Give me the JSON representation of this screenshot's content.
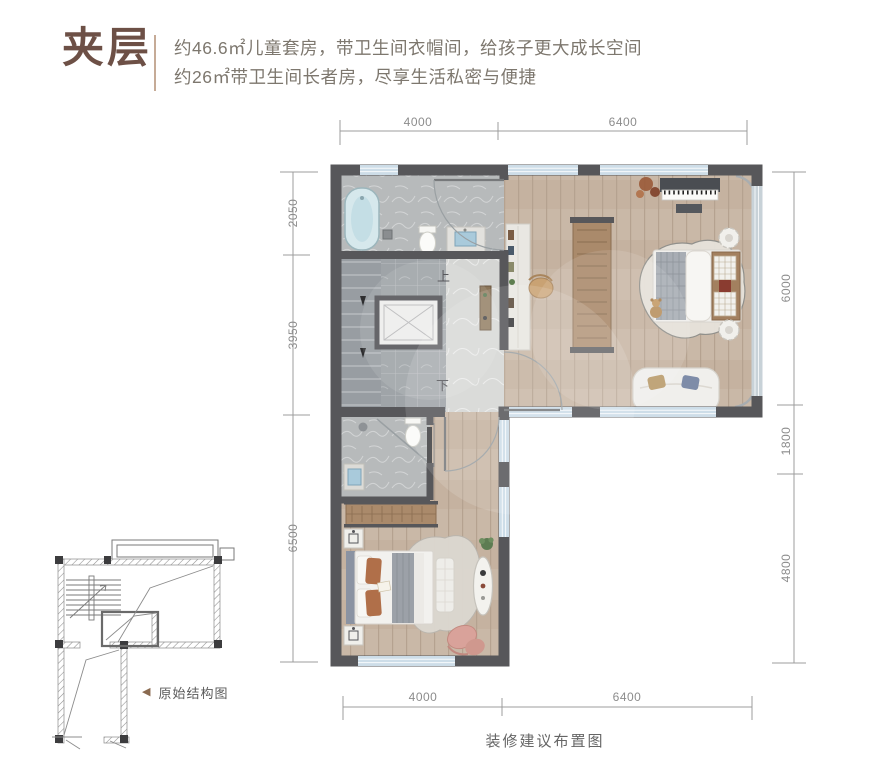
{
  "header": {
    "title": "夹层",
    "desc_line1": "约46.6㎡儿童套房，带卫生间衣帽间，给孩子更大成长空间",
    "desc_line2": "约26㎡带卫生间长者房，尽享生活私密与便捷"
  },
  "plan": {
    "caption": "装修建议布置图",
    "stair_up": "上",
    "stair_down": "下",
    "dims": {
      "top": [
        "4000",
        "6400"
      ],
      "bottom": [
        "4000",
        "6400"
      ],
      "left": [
        "2050",
        "3950",
        "6500"
      ],
      "right": [
        "6000",
        "1800",
        "4800"
      ]
    }
  },
  "structure_diagram": {
    "marker": "◀",
    "label": "原始结构图"
  },
  "colors": {
    "accent_brown": "#6d5046",
    "divider_tan": "#c6ab97",
    "desc_gray": "#7d776e",
    "wall_dark": "#57575a",
    "window_blue": "#cddde8",
    "wood_tan": "#c9b8a7",
    "marble_gray": "#b8bbbc",
    "dim_gray": "#8c8c8c"
  }
}
